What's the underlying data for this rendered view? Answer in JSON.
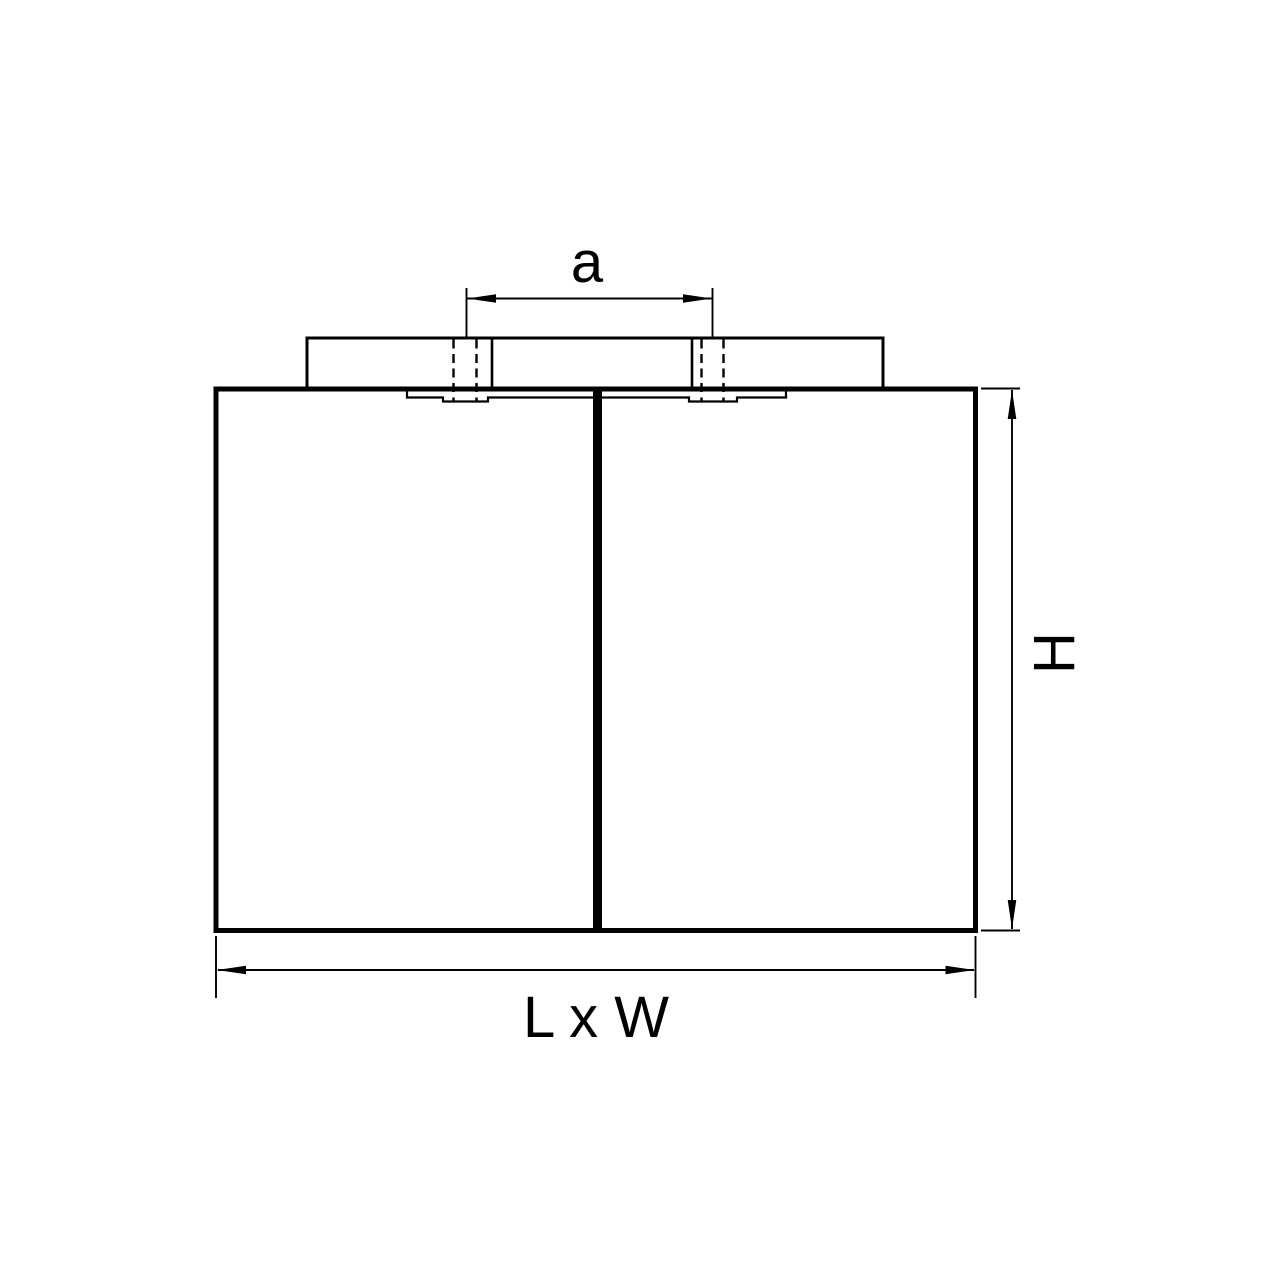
{
  "drawing": {
    "labels": {
      "mounting_distance": "a",
      "height": "H",
      "footprint": "L x W"
    },
    "colors": {
      "line": "#000000",
      "background": "#ffffff"
    }
  }
}
